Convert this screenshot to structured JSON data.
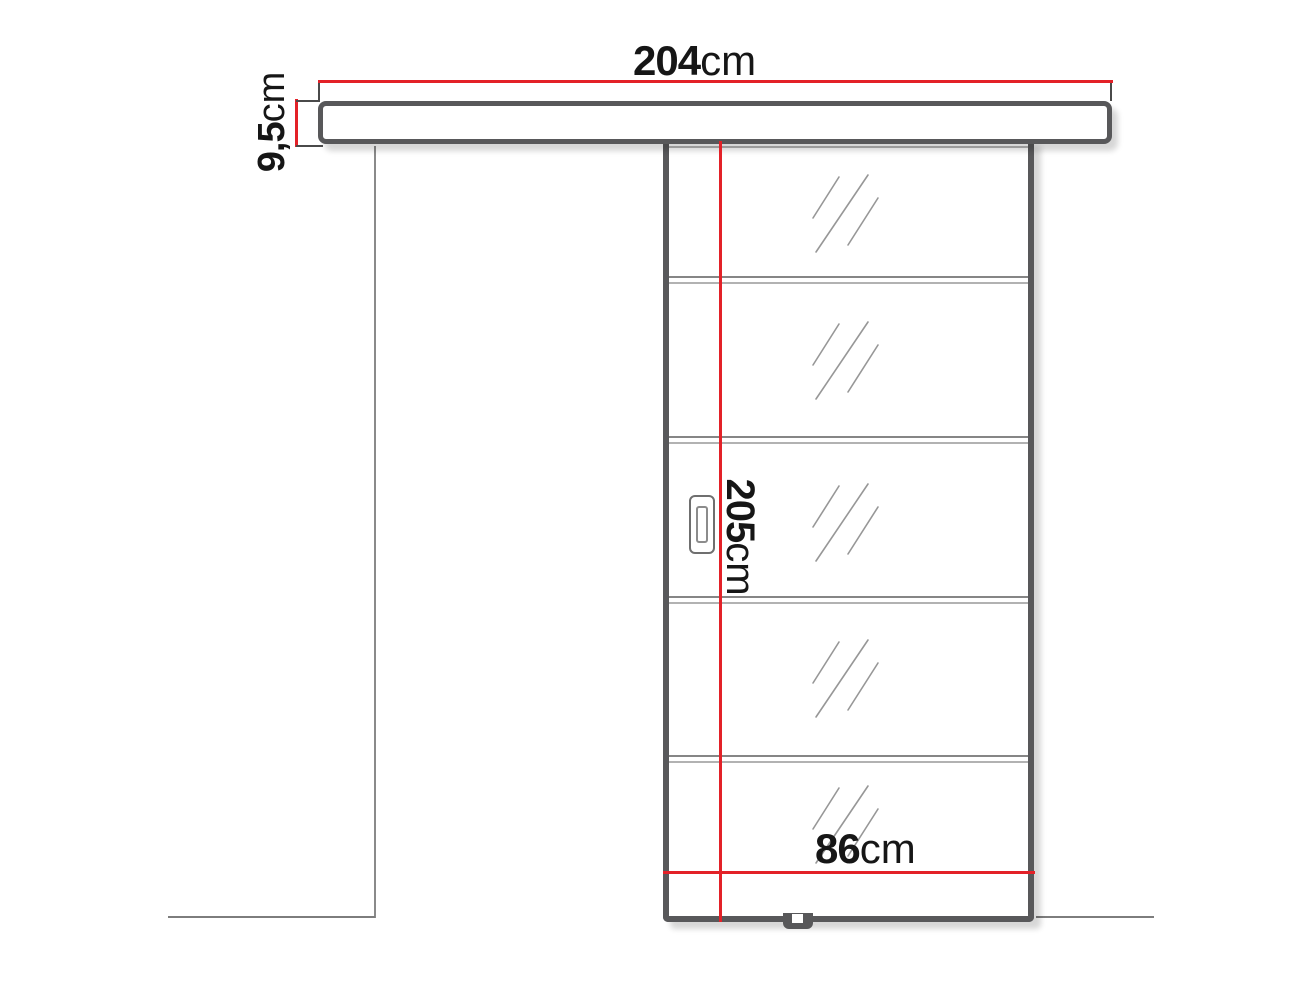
{
  "diagram": {
    "description": "Sliding door with top rail - dimension drawing",
    "colors": {
      "dimension_red": "#e32128",
      "frame_gray": "#58585a",
      "thin_line_gray": "#9b9b9b",
      "text_black": "#161616",
      "background": "#ffffff"
    },
    "rail": {
      "width_label": {
        "value": "204",
        "unit": "cm"
      },
      "height_label": {
        "value": "9,5",
        "unit": "cm"
      }
    },
    "door": {
      "height_label": {
        "value": "205",
        "unit": "cm"
      },
      "width_label": {
        "value": "86",
        "unit": "cm"
      },
      "glass_sections": 5
    }
  }
}
